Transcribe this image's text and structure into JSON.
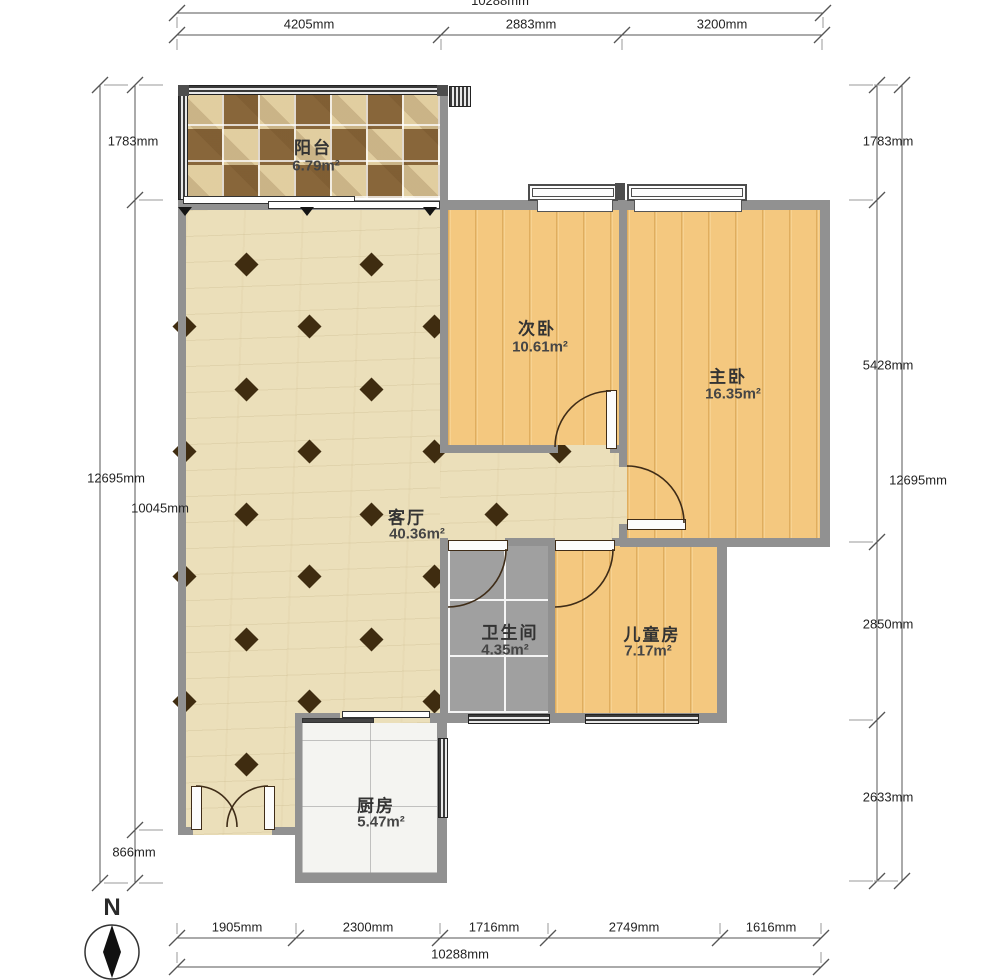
{
  "rooms": {
    "balcony": {
      "name": "阳台",
      "area": "6.79m²"
    },
    "second_bedroom": {
      "name": "次卧",
      "area": "10.61m²"
    },
    "master_bedroom": {
      "name": "主卧",
      "area": "16.35m²"
    },
    "living_room": {
      "name": "客厅",
      "area": "40.36m²"
    },
    "bathroom": {
      "name": "卫生间",
      "area": "4.35m²"
    },
    "kids_room": {
      "name": "儿童房",
      "area": "7.17m²"
    },
    "kitchen": {
      "name": "厨房",
      "area": "5.47m²"
    }
  },
  "dims": {
    "top_total": "10288mm",
    "top_segments": [
      "4205mm",
      "2883mm",
      "3200mm"
    ],
    "bottom_segments": [
      "1905mm",
      "2300mm",
      "1716mm",
      "2749mm",
      "1616mm"
    ],
    "bottom_total": "10288mm",
    "left": {
      "s1": "1783mm",
      "total": "12695mm",
      "inner": "10045mm",
      "s3": "866mm"
    },
    "right": {
      "s1": "1783mm",
      "s2": "5428mm",
      "total": "12695mm",
      "s3": "2850mm",
      "s4": "2633mm"
    }
  },
  "compass": {
    "north_label": "N"
  },
  "colors": {
    "wall": "#919191",
    "wood_floor": "#f4c87f",
    "living_floor": "#ebdfba",
    "bath_tile": "#a0a0a0",
    "kitchen_tile": "#f4f4f1",
    "diamond_accent": "#3f2c10",
    "door_stroke": "#3f2c17"
  }
}
